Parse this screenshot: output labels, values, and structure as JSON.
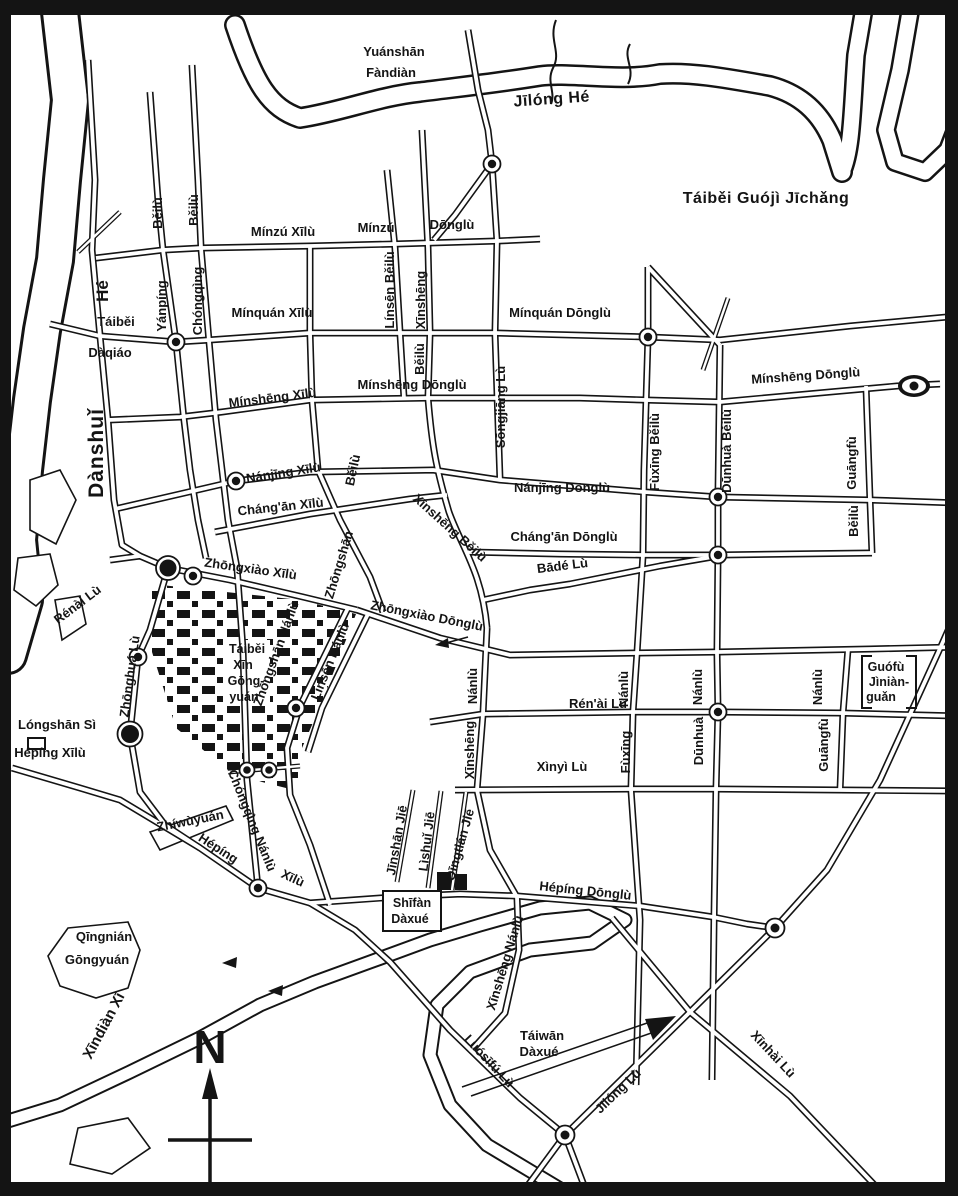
{
  "map": {
    "colors": {
      "paper": "#ffffff",
      "ink": "#141414"
    },
    "symbols": {
      "intersection_marker": "bullseye-dot",
      "gate_marker": "solid-dot",
      "memorial_bracket": "square-brackets",
      "north_arrow": "cross-arrow"
    },
    "compass": {
      "north": "N"
    },
    "labels": {
      "jilong_he": "Jīlóng Hé",
      "yuanshan_line1": "Yuánshān",
      "yuanshan_line2": "Fàndiàn",
      "airport": "Táiběi Guójì Jīchǎng",
      "minzu_xilu": "Mínzú Xīlù",
      "minzu": "Mínzú",
      "minzu_donglu": "Dōnglù",
      "yanping_beilu_top": "Běilù",
      "chongqing_beilu_top": "Běilù",
      "yanping": "Yánpíng",
      "chongqing": "Chóngqìng",
      "he_river": "Hé",
      "taibei_bridge_line1": "Táiběi",
      "taibei_bridge_line2": "Dàqiáo",
      "danshui": "Dànshuǐ",
      "minquan_xilu": "Mínquán Xīlù",
      "minquan_donglu": "Mínquán Dōnglù",
      "minsheng_xilu": "Mínshēng Xīlù",
      "minsheng_donglu": "Mínshēng Dōnglù",
      "minsheng_donglu_east": "Mínshēng Dōnglù",
      "linsen_beilu": "Línsēn Běilù",
      "xinsheng_top": "Xīnshēng",
      "xinsheng_beilu_bottom": "Běilù",
      "songjiang_lu": "Sōngjiāng Lù",
      "nanjing_xilu": "Nánjīng Xīlù",
      "nanjing_donglu": "Nánjīng Dōnglù",
      "changan_xilu": "Cháng'ān Xīlù",
      "changan_donglu": "Cháng'ān Dōnglù",
      "bade_lu": "Bādé Lù",
      "zhongxiao_xilu": "Zhōngxiào Xīlù",
      "zhongxiao_donglu": "Zhōngxiào Dōnglù",
      "zhongshan": "Zhōngshān",
      "zhongshan_beilu": "Běilù",
      "xinsheng_beilu_diag": "Xīnshēng Běilù",
      "fuxing_beilu": "Fùxīng Běilù",
      "dunhua_beilu": "Dūnhuà Běilù",
      "guangfu": "Guāngfù",
      "guangfu_beilu": "Běilù",
      "renai_lu": "Rén'ài Lù",
      "renai_lu_west": "Rénài Lù",
      "xinyi_lu": "Xìnyì Lù",
      "xinsheng_nanlu_top": "Nánlù",
      "xinsheng_south": "Xīnshēng",
      "fuxing_nanlu_top": "Nánlù",
      "fuxing_south": "Fùxīng",
      "dunhua_nanlu_top": "Nánlù",
      "dunhua_south": "Dūnhuà",
      "guangfu_nanlu_top": "Nánlù",
      "guangfu_south": "Guāngfù",
      "guofu_line1": "Guófù",
      "guofu_line2": "Jìniàn-",
      "guofu_line3": "guǎn",
      "zhonghua_lu": "Zhōnghuá Lù",
      "longshan_si": "Lóngshān Sì",
      "heping_xilu": "Hépíng Xīlù",
      "park_line1": "Táiběi",
      "park_line2": "Xīn",
      "park_line3": "Gōng-",
      "park_line4": "yuán",
      "zhongshan_nanlu": "Zhōngshān Nánlù",
      "linsen_nanlu": "Línsēn Nánlù",
      "chongqing_nanlu": "Chóngqìng Nánlù",
      "zhiwuyuan": "Zhíwùyuán",
      "heping_diag": "Hépíng",
      "xilu_diag": "Xīlù",
      "qingnian_line1": "Qīngnián",
      "qingnian_line2": "Gōngyuán",
      "jinshan_jie": "Jīnshān Jiē",
      "lishui_jie": "Lìshuǐ Jiē",
      "qingtian_jie": "Qīngtián Jiē",
      "shifan_line1": "Shīfàn",
      "shifan_line2": "Dàxué",
      "heping_donglu": "Hépíng Dōnglù",
      "xinsheng_nanlu_south": "Xīnshēng Nánlù",
      "taiwan_line1": "Táiwān",
      "taiwan_line2": "Dàxué",
      "luosifu_lu": "Luósīfú Lù",
      "jilong_lu": "Jīlóng Lù",
      "xinhai_lu": "Xīnhài Lù",
      "xindian_xi": "Xīndiàn Xī",
      "compass_n": "N"
    }
  }
}
